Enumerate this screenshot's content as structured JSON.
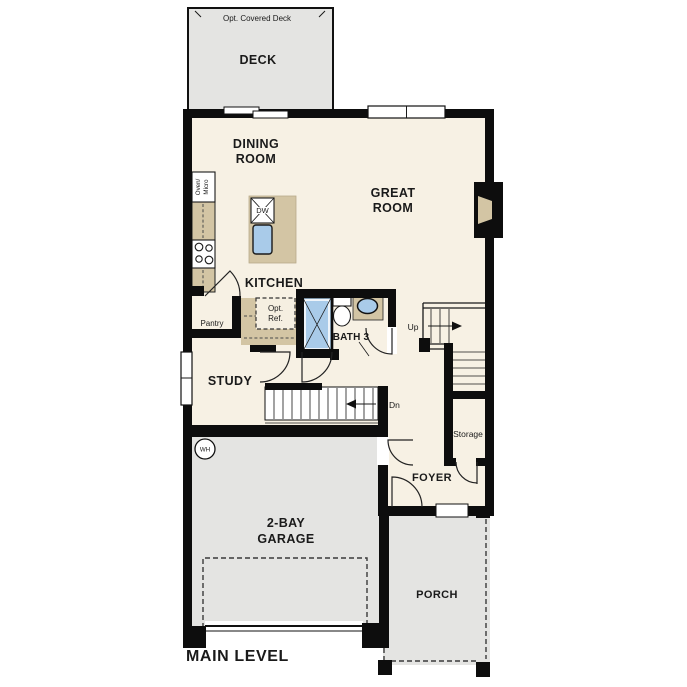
{
  "page": {
    "level_label": "MAIN LEVEL"
  },
  "colors": {
    "wall": "#0d0d0d",
    "floor": "#f7f1e4",
    "outdoor": "#e4e4e2",
    "counter": "#d3c5a4",
    "fixture_blue": "#a9cbe9",
    "ink": "#1a1a1a"
  },
  "rooms": {
    "deck": {
      "label": "DECK",
      "option_note": "Opt. Covered Deck"
    },
    "dining": {
      "line1": "DINING",
      "line2": "ROOM"
    },
    "great": {
      "line1": "GREAT",
      "line2": "ROOM"
    },
    "kitchen": {
      "label": "KITCHEN",
      "pantry": "Pantry",
      "opt_ref_line1": "Opt.",
      "opt_ref_line2": "Ref.",
      "oven_line1": "Oven/",
      "oven_line2": "Micro",
      "dishwasher": "DW"
    },
    "bath3": {
      "label": "BATH 3"
    },
    "study": {
      "label": "STUDY"
    },
    "stairs": {
      "up": "Up",
      "down": "Dn",
      "storage": "Storage"
    },
    "foyer": {
      "label": "FOYER"
    },
    "garage": {
      "line1": "2-BAY",
      "line2": "GARAGE",
      "water_heater": "WH"
    },
    "porch": {
      "label": "PORCH"
    }
  }
}
